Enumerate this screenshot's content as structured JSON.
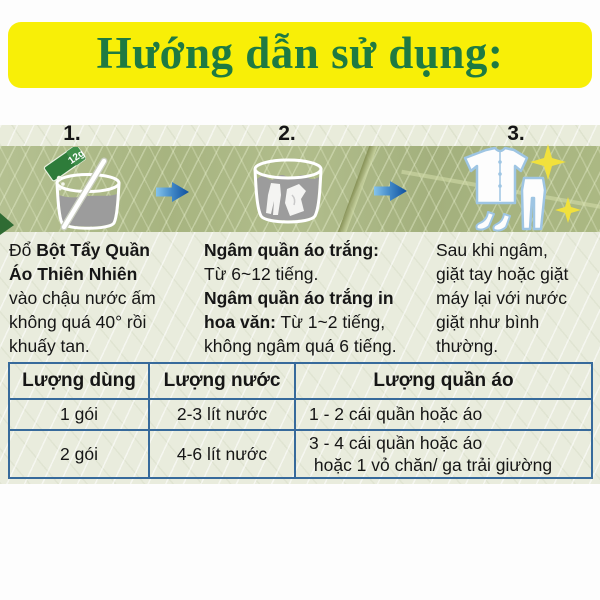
{
  "title": "Hướng dẫn sử dụng:",
  "steps": [
    {
      "number": "1.",
      "icon": "mixing-basin",
      "packet_label": "12g",
      "segments": [
        "Đổ ",
        "Bột Tẩy Quần",
        "Áo Thiên Nhiên",
        "vào chậu nước ấm",
        "không quá 40° rồi",
        "khuấy tan."
      ]
    },
    {
      "number": "2.",
      "icon": "soaking-basin",
      "segments": [
        "Ngâm quần áo trắng:",
        "Từ 6~12 tiếng.",
        "Ngâm quần áo trắng in",
        "hoa văn:",
        " Từ 1~2 tiếng,",
        "không ngâm quá 6 tiếng."
      ]
    },
    {
      "number": "3.",
      "icon": "clean-clothes",
      "segments": [
        "Sau khi ngâm,",
        "giặt tay hoặc giặt",
        "máy lại với nước",
        "giặt như bình",
        "thường."
      ]
    }
  ],
  "table": {
    "headers": [
      "Lượng dùng",
      "Lượng nước",
      "Lượng quần áo"
    ],
    "rows": [
      {
        "cells": [
          "1 gói",
          "2-3 lít nước",
          "1 - 2 cái quần hoặc áo"
        ]
      },
      {
        "cells": [
          "2 gói",
          "4-6 lít nước",
          "3 - 4 cái quần hoặc áo\n hoặc 1 vỏ chăn/ ga trải giường"
        ]
      }
    ]
  },
  "colors": {
    "banner_yellow": "#f8ef07",
    "title_green": "#1e7a42",
    "table_border_blue": "#376a9b",
    "arrow_blue_dark": "#0d4f9e",
    "arrow_blue_light": "#85c4ec",
    "sparkle_yellow": "#f1e13c",
    "leaf_green": "#acb985",
    "water_gray": "#9c9c9c",
    "packet_green": "#2e7c3a"
  }
}
